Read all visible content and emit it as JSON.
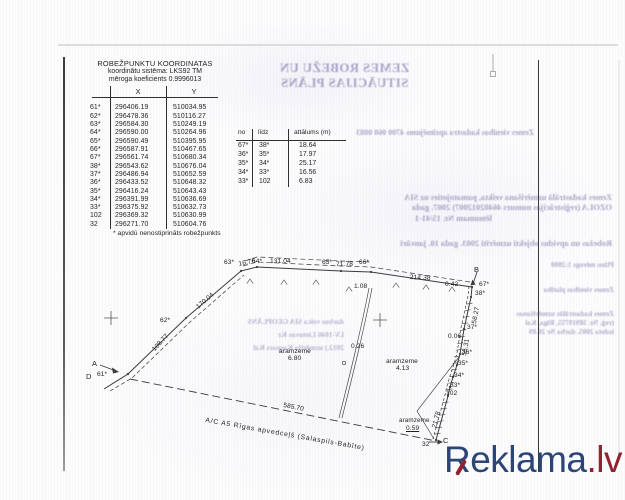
{
  "coord_table": {
    "title": "ROBEŽPUNKTU KOORDINATAS",
    "subtitle1": "koordinātu sistēma: LKS92  TM",
    "subtitle2": "mēroga koeficients 0.9996013",
    "col_x": "X",
    "col_y": "Y",
    "rows": [
      [
        "61*",
        "296406.19",
        "510034.95"
      ],
      [
        "62*",
        "296478.36",
        "510116.27"
      ],
      [
        "63*",
        "296584.30",
        "510249.19"
      ],
      [
        "64*",
        "296590.00",
        "510264.96"
      ],
      [
        "65*",
        "296590.49",
        "510395.95"
      ],
      [
        "66*",
        "296587.91",
        "510467.65"
      ],
      [
        "67*",
        "296561.74",
        "510680.34"
      ],
      [
        "38*",
        "296543.62",
        "510676.04"
      ],
      [
        "37*",
        "296486.94",
        "510652.59"
      ],
      [
        "36*",
        "296433.52",
        "510648.32"
      ],
      [
        "35*",
        "296416.24",
        "510643.43"
      ],
      [
        "34*",
        "296391.99",
        "510636.69"
      ],
      [
        "33*",
        "296375.92",
        "510632.73"
      ],
      [
        "102",
        "296369.32",
        "510630.99"
      ],
      [
        "32",
        "296271.70",
        "510604.76"
      ]
    ],
    "footnote": "* apvidū nenostiprināts robežpunkts"
  },
  "dist_table": {
    "col_no": "no",
    "col_lidz": "līdz",
    "col_att": "attālums (m)",
    "rows": [
      [
        "67*",
        "38*",
        "18.64"
      ],
      [
        "36*",
        "35*",
        "17.97"
      ],
      [
        "35*",
        "34*",
        "25.17"
      ],
      [
        "34*",
        "33*",
        "16.56"
      ],
      [
        "33*",
        "102",
        "6.83"
      ]
    ]
  },
  "bleed": {
    "title_line1": "ZEMES ROBEŽU UN",
    "title_line2": "SITUĀCIJAS PLĀNS",
    "kadastra_line": "Zemes vienības kadastra apzīmējums 4700 060 0083",
    "block_line1": "Zemes kadastrālā uzmērīšana veikta, pamatojoties uz SIA",
    "block_line2": "OZOLA (reģistrācijas numurs 46402012007) 2007. gada",
    "block_line3": "lēmumam Nr. 15/41-1",
    "robezas_line": "Robežas un apvidus objekti uzmērīti 2003. gada 10. janvārī",
    "left_block": [
      "darbus veica SIA GEOPLĀNS",
      "LV-1046 Lietuvas Kr",
      "2012.) uzmērīja Kaspars Kal"
    ],
    "right_block": [
      "Plāns mērogs 1:2000",
      "Zemes vienības platība",
      "Zemes kadastrālās uzmērīšanas",
      "(reģ. Nr. 38919755, Rīga, Kal",
      "izdota 2005. darba Nr 20.09"
    ]
  },
  "plan": {
    "labels": [
      {
        "t": "A",
        "x": 92,
        "y": 359,
        "fs": 7.5
      },
      {
        "t": "D",
        "x": 86,
        "y": 372,
        "fs": 7.5
      },
      {
        "t": "61*",
        "x": 97,
        "y": 371
      },
      {
        "t": "108.77",
        "x": 151,
        "y": 348,
        "r": -47
      },
      {
        "t": "62*",
        "x": 160,
        "y": 317
      },
      {
        "t": "170.04",
        "x": 195,
        "y": 305,
        "r": -40
      },
      {
        "t": "63*",
        "x": 224,
        "y": 259
      },
      {
        "t": "16.76",
        "x": 238,
        "y": 261,
        "r": -12
      },
      {
        "t": "64*",
        "x": 252,
        "y": 258
      },
      {
        "t": "131.04",
        "x": 270,
        "y": 258
      },
      {
        "t": "65*",
        "x": 322,
        "y": 259
      },
      {
        "t": "71.78",
        "x": 336,
        "y": 261
      },
      {
        "t": "66*",
        "x": 359,
        "y": 259
      },
      {
        "t": "214.38",
        "x": 410,
        "y": 274,
        "r": 3
      },
      {
        "t": "B",
        "x": 474,
        "y": 265,
        "fs": 7.5
      },
      {
        "t": "0.42",
        "x": 445,
        "y": 281
      },
      {
        "t": "67*",
        "x": 479,
        "y": 281
      },
      {
        "t": "38*",
        "x": 475,
        "y": 290
      },
      {
        "t": "58.27",
        "x": 471,
        "y": 323,
        "r": -79
      },
      {
        "t": "37*",
        "x": 467,
        "y": 324
      },
      {
        "t": "0.06",
        "x": 448,
        "y": 333
      },
      {
        "t": "55.31",
        "x": 461,
        "y": 355,
        "r": -79
      },
      {
        "t": "36*",
        "x": 462,
        "y": 349
      },
      {
        "t": "35*",
        "x": 458,
        "y": 360
      },
      {
        "t": "34*",
        "x": 454,
        "y": 372
      },
      {
        "t": "33*",
        "x": 450,
        "y": 382
      },
      {
        "t": "102",
        "x": 446,
        "y": 390
      },
      {
        "t": "21.78",
        "x": 431,
        "y": 427,
        "r": -75
      },
      {
        "t": "32",
        "x": 422,
        "y": 441
      },
      {
        "t": "C",
        "x": 443,
        "y": 436,
        "fs": 7.5
      },
      {
        "t": "585.70",
        "x": 284,
        "y": 402,
        "r": 11
      },
      {
        "t": "1.08",
        "x": 354,
        "y": 283
      },
      {
        "t": "0.26",
        "x": 351,
        "y": 343
      },
      {
        "t": "aramzeme",
        "x": 279,
        "y": 348
      },
      {
        "t": "6.80",
        "x": 288,
        "y": 355
      },
      {
        "t": "aramzeme",
        "x": 386,
        "y": 358
      },
      {
        "t": "4.13",
        "x": 396,
        "y": 365
      },
      {
        "t": "aramzeme",
        "x": 399,
        "y": 417,
        "fs": 6.3
      },
      {
        "t": "0.59",
        "x": 406,
        "y": 425,
        "u": 1
      },
      {
        "t": "A/C  A5  Rīgas apvedceļš (Salaspils-Babīte)",
        "x": 206,
        "y": 417,
        "r": 10,
        "ls": 0.8,
        "fs": 6.8
      }
    ]
  },
  "watermark": {
    "brand": "Reklama",
    "tld": ".lv",
    "brand_color": "#2b4577",
    "tld_color": "#93212f"
  }
}
